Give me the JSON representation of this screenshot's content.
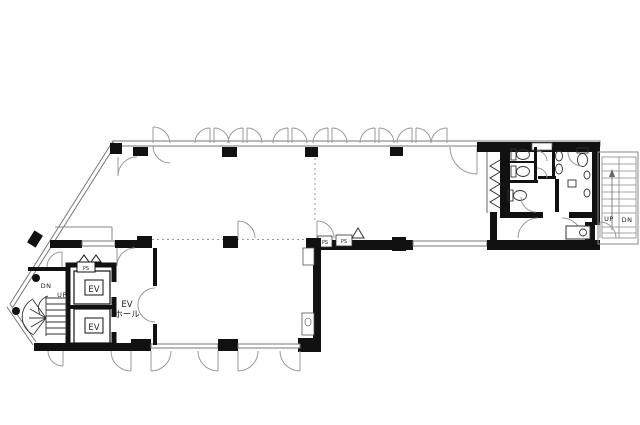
{
  "plan": {
    "elevators": [
      {
        "label": "EV"
      },
      {
        "label": "EV"
      }
    ],
    "ev_hall": {
      "line1": "EV",
      "line2": "ホール"
    },
    "shaft_labels": {
      "ev_ps": "PS",
      "junction_ps1": "PS",
      "junction_ps2": "PS"
    },
    "left_stair": {
      "down": "DN",
      "up": "UP"
    },
    "right_stair": {
      "up": "UP",
      "down": "DN"
    },
    "colors": {
      "background": "#ffffff",
      "wall": "#111111",
      "window_line": "#777777",
      "door_arc": "#999999",
      "dotted_partition": "#999999"
    }
  }
}
